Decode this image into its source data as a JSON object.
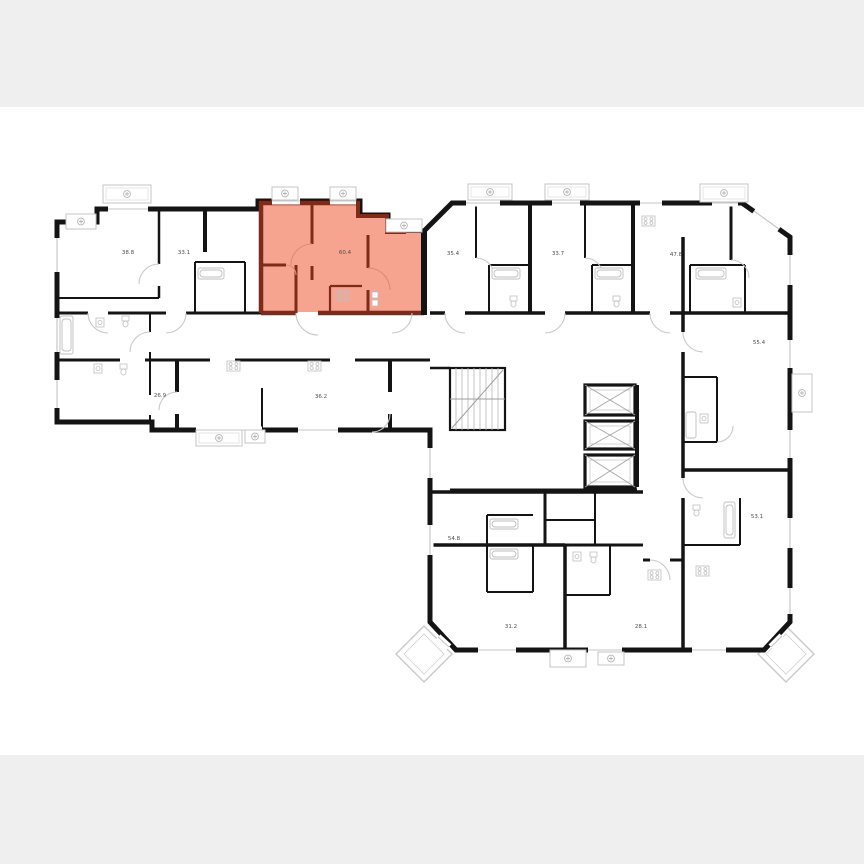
{
  "page": {
    "background_band_color": "#efefef",
    "canvas_color": "#ffffff",
    "content": "residential floor plan with one highlighted apartment"
  },
  "palette": {
    "wall": "#141414",
    "detail_line": "#c9c9c9",
    "fixture_line": "#bfbfbf",
    "highlight_fill": "#f6a390",
    "highlight_wall": "#7e2b19",
    "highlight_door": "#e08a74",
    "label_color": "#4d4d4d"
  },
  "plan": {
    "highlighted_apartment": {
      "area": "60.4"
    },
    "apartments": [
      {
        "area": "38.8"
      },
      {
        "area": "33.1"
      },
      {
        "area": "60.4"
      },
      {
        "area": "35.4"
      },
      {
        "area": "33.7"
      },
      {
        "area": "47.8"
      },
      {
        "area": "55.4"
      },
      {
        "area": "26.9"
      },
      {
        "area": "36.2"
      },
      {
        "area": "54.8"
      },
      {
        "area": "53.1"
      },
      {
        "area": "31.2"
      },
      {
        "area": "28.1"
      }
    ]
  },
  "icons": {
    "vent": "fan-icon",
    "stove": "stove-icon",
    "bathtub": "bathtub-icon",
    "toilet": "toilet-icon",
    "sink": "sink-icon",
    "stairs": "stairs-icon",
    "elevator": "elevator-x-icon"
  }
}
